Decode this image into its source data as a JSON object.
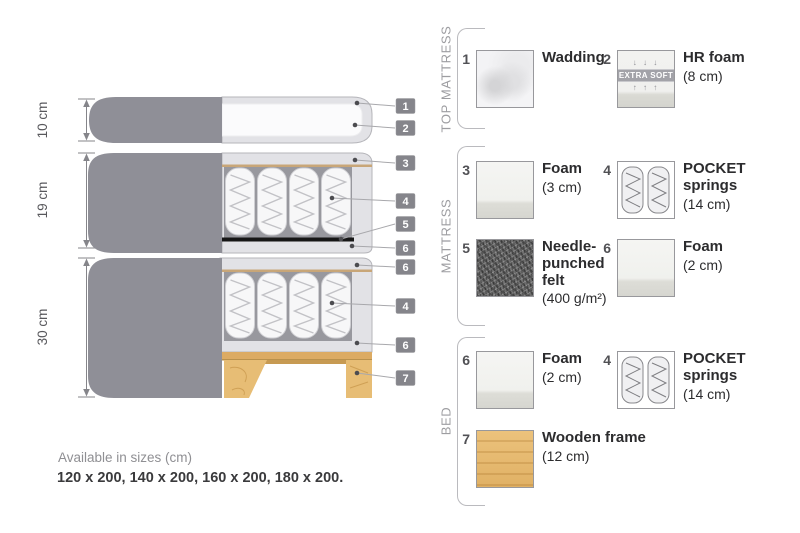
{
  "diagram": {
    "dimension_labels": [
      "10 cm",
      "19 cm",
      "30 cm"
    ],
    "callouts": [
      "1",
      "2",
      "3",
      "4",
      "5",
      "6",
      "6",
      "4",
      "6",
      "7"
    ]
  },
  "legend": {
    "sections": [
      {
        "title": "TOP MATTRESS",
        "items": [
          {
            "num": "1",
            "name": "Wadding",
            "size": ""
          },
          {
            "num": "2",
            "name": "HR foam",
            "size": "(8 cm)",
            "badge": "EXTRA SOFT",
            "arrows_down": "↓ ↓ ↓",
            "arrows_up": "↑ ↑ ↑"
          }
        ]
      },
      {
        "title": "MATTRESS",
        "items": [
          {
            "num": "3",
            "name": "Foam",
            "size": "(3 cm)"
          },
          {
            "num": "4",
            "name": "POCKET\nsprings",
            "size": "(14 cm)"
          },
          {
            "num": "5",
            "name": "Needle-\npunched\nfelt",
            "size": "(400 g/m²)"
          },
          {
            "num": "6",
            "name": "Foam",
            "size": "(2 cm)"
          }
        ]
      },
      {
        "title": "BED",
        "items": [
          {
            "num": "6",
            "name": "Foam",
            "size": "(2 cm)"
          },
          {
            "num": "4",
            "name": "POCKET\nsprings",
            "size": "(14 cm)"
          },
          {
            "num": "7",
            "name": "Wooden frame",
            "size": "(12 cm)"
          }
        ]
      }
    ]
  },
  "footer": {
    "availability": "Available in sizes (cm)",
    "sizes": "120 x 200, 140 x 200, 160 x 200, 180 x 200."
  }
}
